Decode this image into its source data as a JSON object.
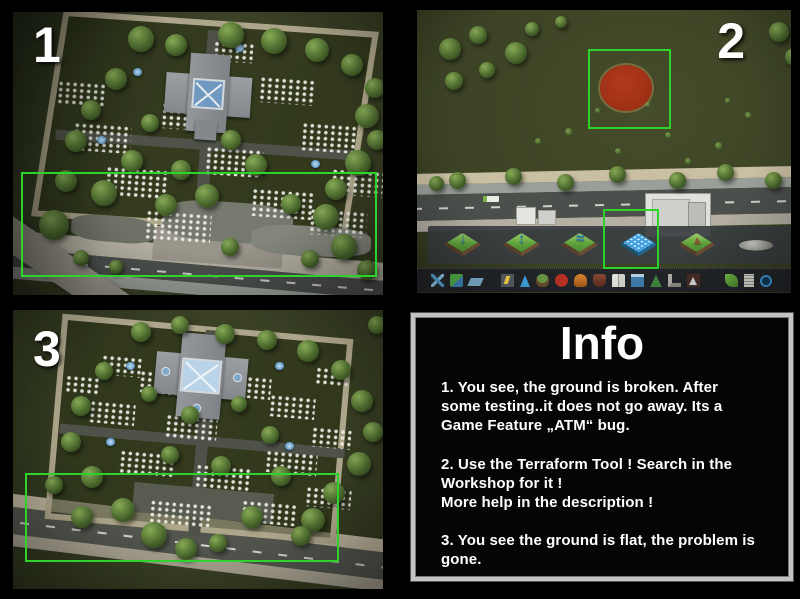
{
  "panels": {
    "one": {
      "label": "1"
    },
    "two": {
      "label": "2"
    },
    "three": {
      "label": "3"
    }
  },
  "game": {
    "terraform_tools": [
      {
        "name": "shift-terrain-icon",
        "glyph": "↓",
        "selected": false
      },
      {
        "name": "level-terrain-icon",
        "glyph": "↕",
        "selected": false
      },
      {
        "name": "soften-terrain-icon",
        "glyph": "≈",
        "selected": false
      },
      {
        "name": "flatten-terrain-icon",
        "glyph": "",
        "selected": true
      },
      {
        "name": "slope-terrain-icon",
        "glyph": "▲",
        "selected": false
      },
      {
        "name": "rocks-brush-icon",
        "glyph": "",
        "selected": false
      }
    ],
    "menu_icons": [
      "roads-icon",
      "zoning-icon",
      "districts-icon",
      "electricity-icon",
      "water-icon",
      "garbage-icon",
      "healthcare-icon",
      "fire-icon",
      "police-icon",
      "education-icon",
      "transport-icon",
      "parks-icon",
      "unique-buildings-icon",
      "monuments-icon",
      "resources-icon",
      "policies-icon",
      "terraform-mod-icon"
    ]
  },
  "info": {
    "title": "Info",
    "items": [
      "1. You see, the ground is broken. After some testing..it does not go away. Its a Game Feature „ATM“ bug.",
      "2. Use the Terraform Tool ! Search in the Workshop for it !\nMore help in the description !",
      "3. You see the ground is flat, the problem is gone."
    ]
  },
  "colors": {
    "highlight_green": "#2bd32b",
    "brush_red": "#a53419"
  }
}
